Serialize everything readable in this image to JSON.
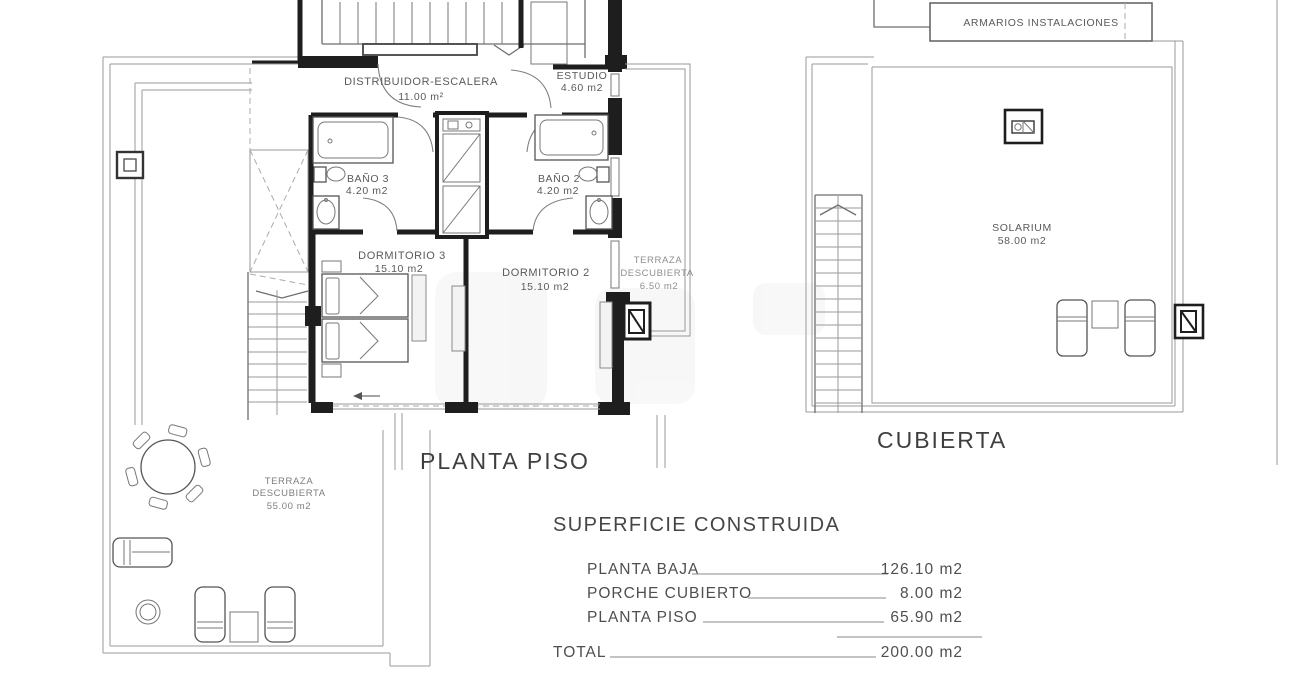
{
  "plans": {
    "planta_piso": {
      "title": "PLANTA PISO",
      "rooms": {
        "distribuidor": {
          "name": "DISTRIBUIDOR-ESCALERA",
          "area": "11.00 m²"
        },
        "estudio": {
          "name": "ESTUDIO",
          "area": "4.60 m2"
        },
        "bano3": {
          "name": "BAÑO 3",
          "area": "4.20 m2"
        },
        "bano2": {
          "name": "BAÑO 2",
          "area": "4.20 m2"
        },
        "dormitorio3": {
          "name": "DORMITORIO 3",
          "area": "15.10 m2"
        },
        "dormitorio2": {
          "name": "DORMITORIO 2",
          "area": "15.10 m2"
        },
        "terraza_lateral": {
          "name_line1": "TERRAZA",
          "name_line2": "DESCUBIERTA",
          "area": "6.50 m2"
        },
        "terraza_principal": {
          "name_line1": "TERRAZA",
          "name_line2": "DESCUBIERTA",
          "area": "55.00 m2"
        }
      }
    },
    "cubierta": {
      "title": "CUBIERTA",
      "rooms": {
        "armarios": {
          "name": "ARMARIOS INSTALACIONES"
        },
        "solarium": {
          "name": "SOLARIUM",
          "area": "58.00 m2"
        }
      }
    }
  },
  "summary": {
    "title": "SUPERFICIE CONSTRUIDA",
    "rows": [
      {
        "label": "PLANTA BAJA",
        "value": "126.10 m2"
      },
      {
        "label": "PORCHE CUBIERTO",
        "value": "8.00 m2"
      },
      {
        "label": "PLANTA PISO",
        "value": "65.90 m2"
      }
    ],
    "total": {
      "label": "TOTAL",
      "value": "200.00 m2"
    }
  },
  "colors": {
    "wall": "#1e1e1e",
    "thin_line": "#9a9a9a",
    "text": "#5a5a5a",
    "title_text": "#3f3f3f",
    "background": "#ffffff"
  }
}
